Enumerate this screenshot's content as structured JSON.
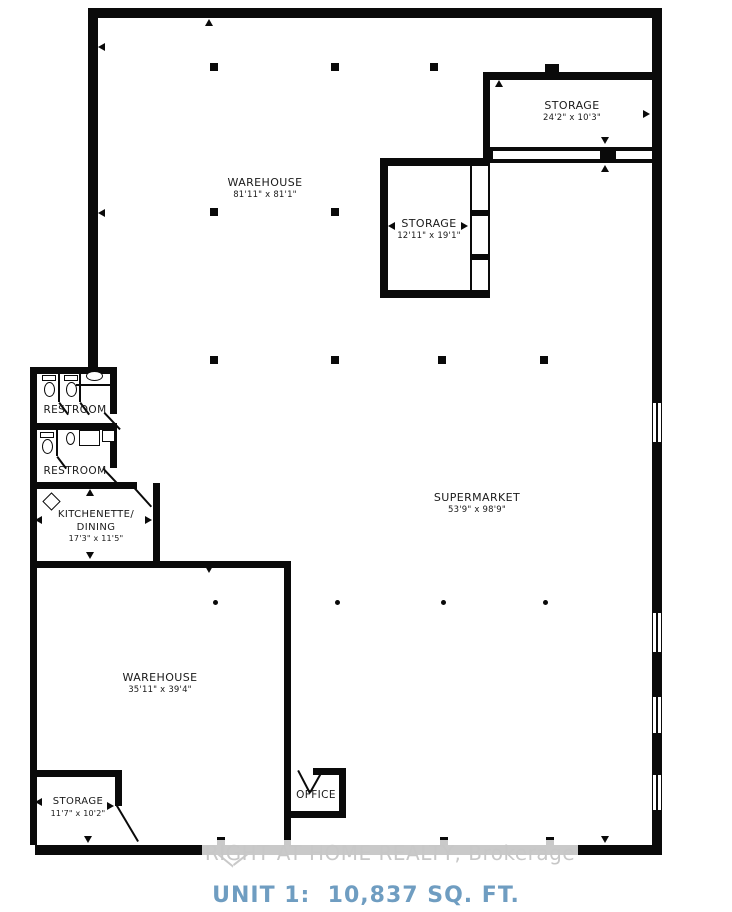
{
  "plan": {
    "rooms": {
      "warehouse_top": {
        "label": "WAREHOUSE",
        "dims": "81'11\" x 81'1\""
      },
      "storage_top_right": {
        "label": "STORAGE",
        "dims": "24'2\" x 10'3\""
      },
      "storage_mid": {
        "label": "STORAGE",
        "dims": "12'11\" x 19'1\""
      },
      "restroom_upper": {
        "label": "RESTROOM"
      },
      "restroom_lower": {
        "label": "RESTROOM"
      },
      "kitchenette": {
        "label_line1": "KITCHENETTE/",
        "label_line2": "DINING",
        "dims": "17'3\" x 11'5\""
      },
      "supermarket": {
        "label": "SUPERMARKET",
        "dims": "53'9\" x 98'9\""
      },
      "warehouse_bottom": {
        "label": "WAREHOUSE",
        "dims": "35'11\" x 39'4\""
      },
      "storage_bottom_left": {
        "label": "STORAGE",
        "dims": "11'7\" x 10'2\""
      },
      "office": {
        "label": "OFFICE"
      }
    },
    "watermark_text": "RIGHT AT HOME REALTY, Brokerage",
    "unit_caption": "UNIT 1:  10,837 SQ. FT.",
    "colors": {
      "wall": "#0a0a0a",
      "unit_caption": "#6f9dc1",
      "watermark": "#c7c7c7"
    }
  }
}
